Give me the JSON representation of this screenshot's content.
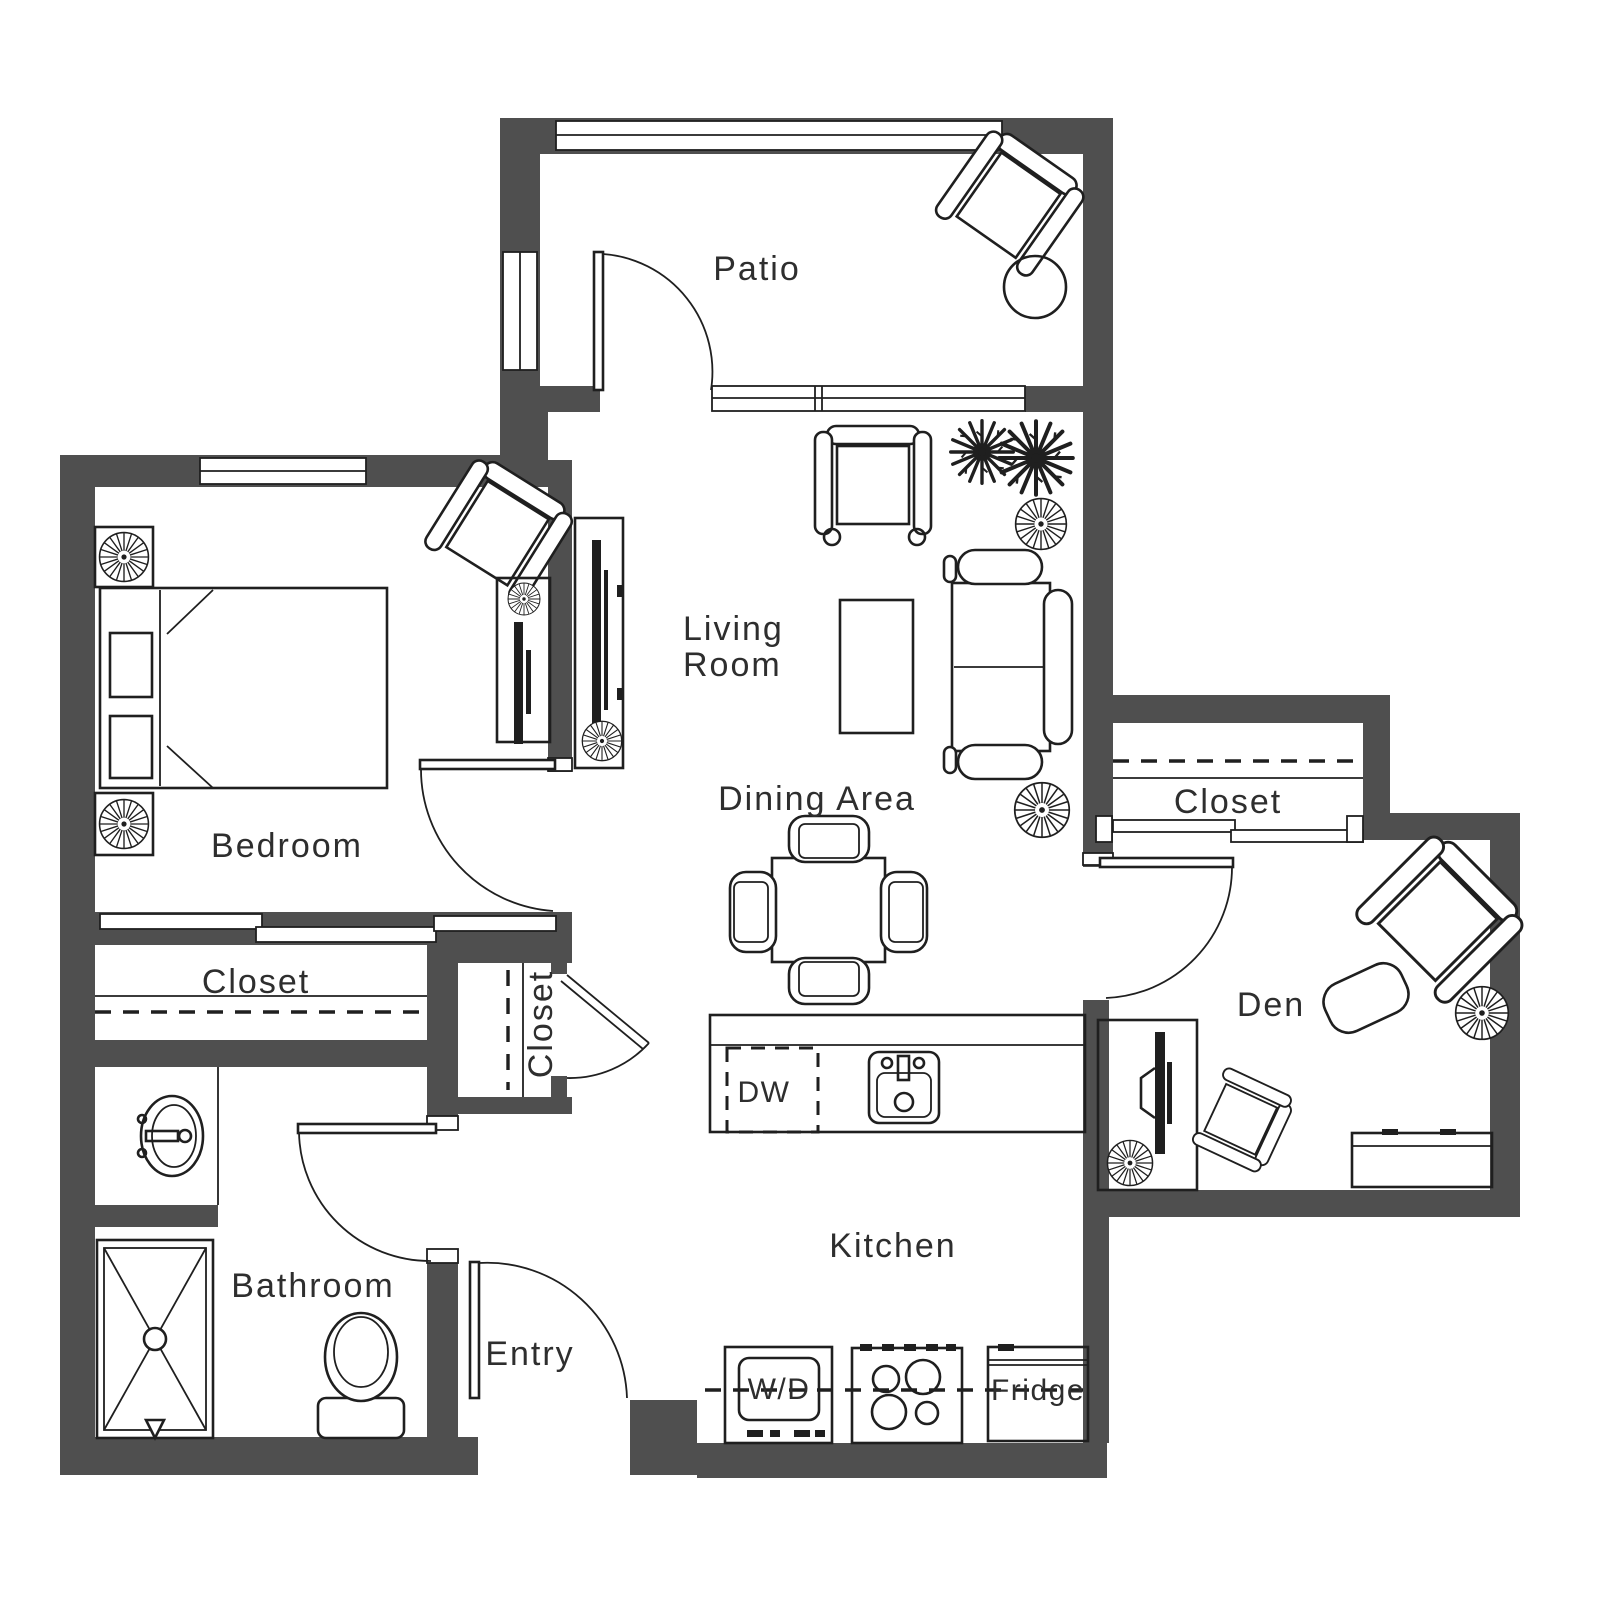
{
  "plan": {
    "rooms": {
      "patio": "Patio",
      "living_room_line1": "Living",
      "living_room_line2": "Room",
      "dining_area": "Dining Area",
      "bedroom": "Bedroom",
      "bedroom_closet": "Closet",
      "entry_closet": "Closet",
      "den_closet": "Closet",
      "den": "Den",
      "bathroom": "Bathroom",
      "entry": "Entry",
      "kitchen": "Kitchen"
    },
    "appliances": {
      "dishwasher": "DW",
      "washer_dryer": "W/D",
      "fridge": "Fridge"
    },
    "colors": {
      "wall": "#4f4f4f",
      "line": "#1f1f1f",
      "text": "#2e2e2e",
      "background": "#ffffff"
    }
  }
}
